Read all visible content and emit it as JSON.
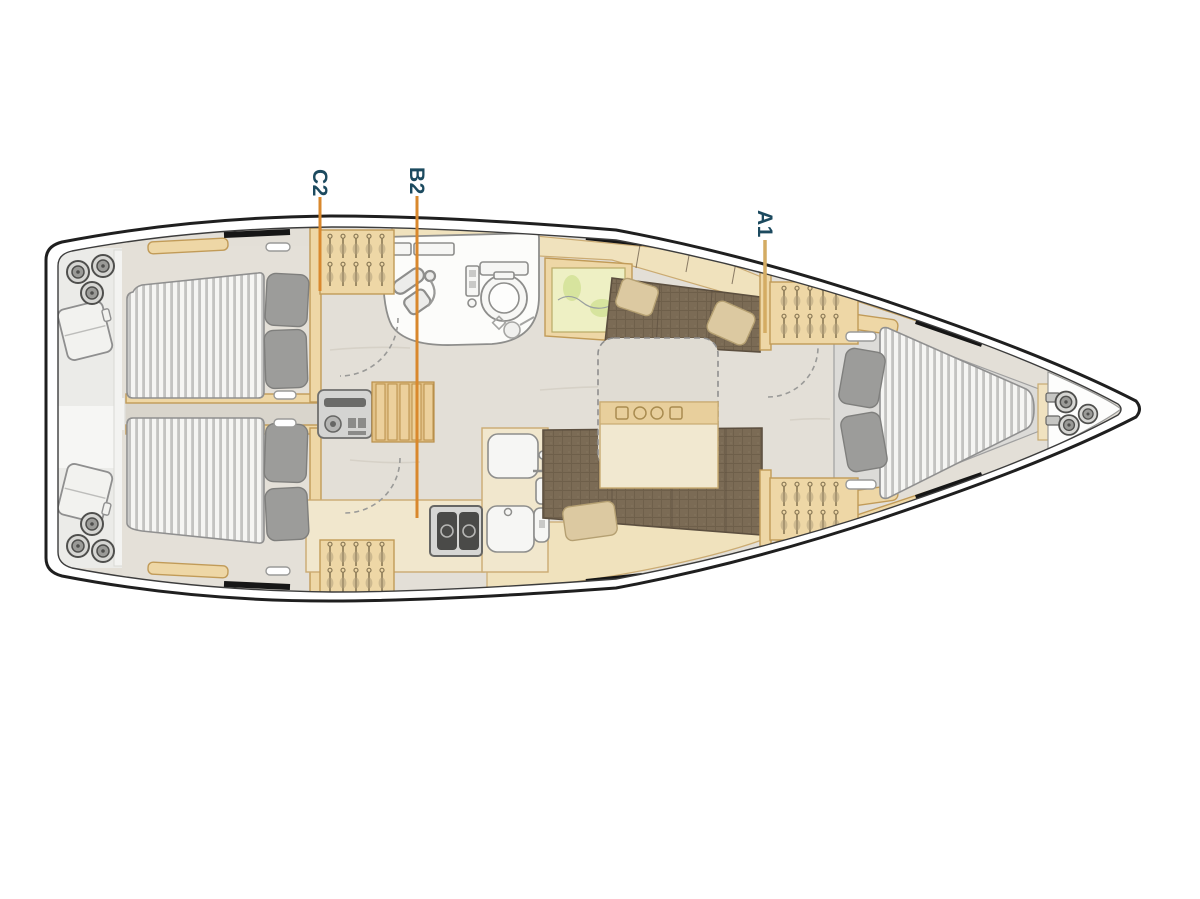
{
  "callouts": [
    {
      "id": "C2",
      "label": "C2"
    },
    {
      "id": "B2",
      "label": "B2"
    },
    {
      "id": "A1",
      "label": "A1"
    }
  ],
  "colors": {
    "label-text": "#1c4a5f",
    "callout-orange": "#d9882d",
    "callout-tan": "#d4ac63",
    "hull-line": "#1f1f1f",
    "deck-line": "#3c3c3c",
    "wood": "#eed7a6",
    "wood-dark": "#c19b58",
    "wood-light": "#f0e2bd",
    "counter": "#f1e7cd",
    "counter-line": "#cbab72",
    "floor": "#e3dfd7",
    "floor-dark": "#d9d5cc",
    "floor-streak": "#d6d1c7",
    "room-white": "#fcfcfa",
    "line-gray": "#8e8e8c",
    "sofa": "#7b6b55",
    "sofa-dark": "#5c4f3f",
    "sofa-pillow": "#dcc9a1",
    "sofa-pillow-line": "#b5a072",
    "mattress": "#f5f5f3",
    "mattress-stripe": "#c3c3c1",
    "pillow": "#9c9c9a",
    "pillow-line": "#7f7f7d",
    "equip": "#d4d4d2",
    "stern-gray": "#ebebe8"
  }
}
